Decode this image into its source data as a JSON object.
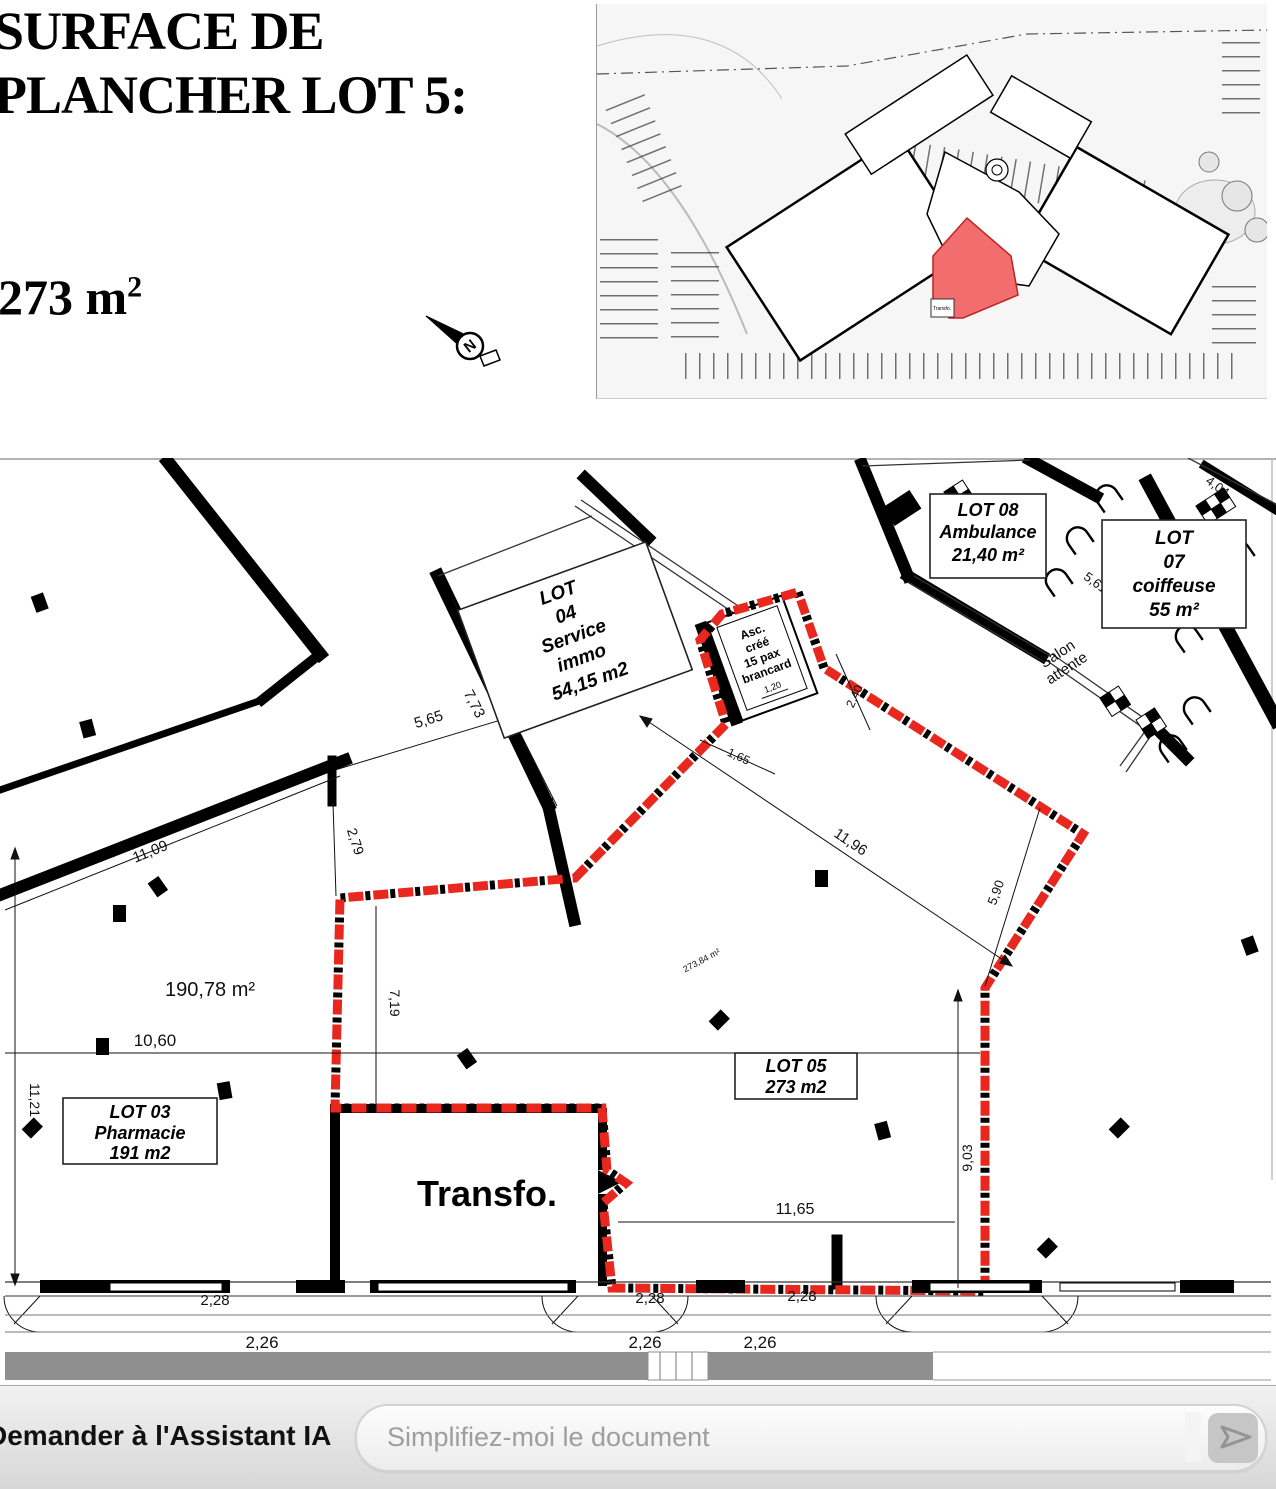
{
  "header": {
    "title_line1": "SURFACE DE",
    "title_line2": "PLANCHER LOT 5:",
    "area_text": "273 m",
    "area_exponent": "2"
  },
  "compass": {
    "north_label": "N"
  },
  "site_plan": {
    "transfo_label": "Transfo.",
    "highlight_color": "#f26d6d"
  },
  "floor_plan": {
    "lot04": {
      "l1": "LOT",
      "l2": "04",
      "l3": "Service",
      "l4": "immo",
      "l5": "54,15 m2"
    },
    "lot08": {
      "l1": "LOT 08",
      "l2": "Ambulance",
      "l3": "21,40 m²"
    },
    "lot07": {
      "l1": "LOT",
      "l2": "07",
      "l3": "coiffeuse",
      "l4": "55 m²"
    },
    "lot03": {
      "l1": "LOT 03",
      "l2": "Pharmacie",
      "l3": "191 m2"
    },
    "lot05": {
      "l1": "LOT 05",
      "l2": "273 m2"
    },
    "transfo_label": "Transfo.",
    "elevator": {
      "l1": "Asc.",
      "l2": "créé",
      "l3": "15 pax",
      "l4": "brancard",
      "dim_inner": "1,20"
    },
    "accueil": {
      "l1": "Accueil/",
      "l2": "Caisse"
    },
    "salon": {
      "l1": "Salon",
      "l2": "attente"
    },
    "areas": {
      "pharmacie_zone": "190,78 m²",
      "lot05_zone": "273,84 m²"
    },
    "dims": {
      "d7_73": "7,73",
      "d5_65": "5,65",
      "d2_79": "2,79",
      "d11_09": "11,09",
      "d7_19": "7,19",
      "d10_60": "10,60",
      "d11_21": "11,21",
      "d11_96": "11,96",
      "d5_90": "5,90",
      "d9_03": "9,03",
      "d11_65": "11,65",
      "d1_65": "1,65",
      "d2_40": "2,40",
      "d5_61": "5,61",
      "d4_04": "4,04",
      "d8_05": "8,05",
      "d2_28": "2,28",
      "d2_26": "2,26"
    }
  },
  "assistant_bar": {
    "label": "Demander à l'Assistant IA",
    "placeholder": "Simplifiez-moi le document"
  }
}
